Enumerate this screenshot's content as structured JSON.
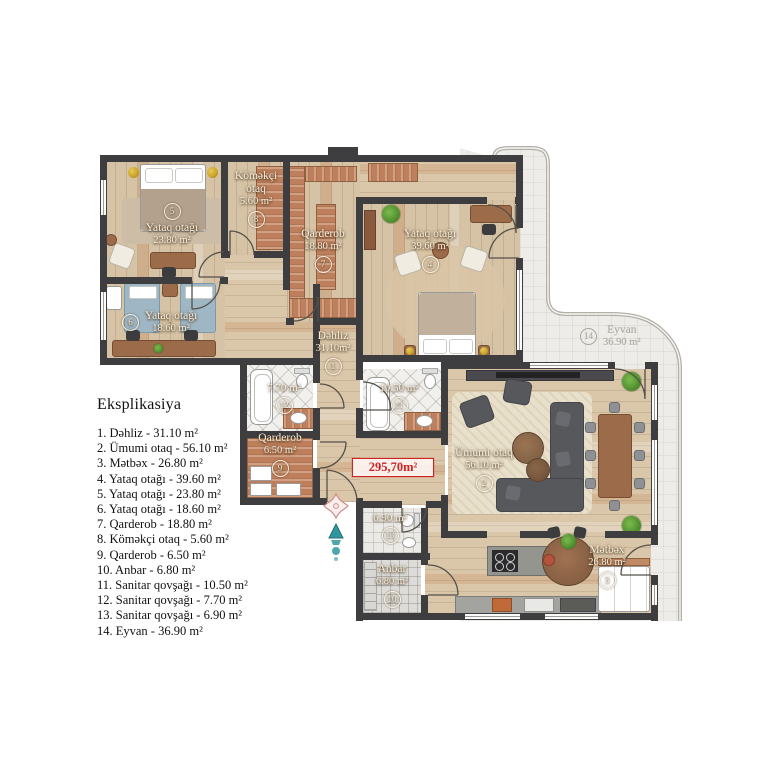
{
  "plan": {
    "total_area": "295,70m²",
    "rooms": {
      "r1": {
        "num": "1",
        "name": "Dəhliz",
        "area": "31.10m²"
      },
      "r2": {
        "num": "2",
        "name": "Ümumi otaq",
        "area": "56.10 m²"
      },
      "r3": {
        "num": "3",
        "name": "Mətbəx",
        "area": "26.80 m²"
      },
      "r4": {
        "num": "4",
        "name": "Yataq otağı",
        "area": "39.60 m²"
      },
      "r5": {
        "num": "5",
        "name": "Yataq otağı",
        "area": "23.80 m²"
      },
      "r6": {
        "num": "6",
        "name": "Yataq otağı",
        "area": "18.60 m²"
      },
      "r7": {
        "num": "7",
        "name": "Qarderob",
        "area": "18.80 m²"
      },
      "r8": {
        "num": "8",
        "name": "Köməkçi",
        "name2": "otaq",
        "area": "5.60 m²"
      },
      "r9": {
        "num": "9",
        "name": "Qarderob",
        "area": "6.50 m²"
      },
      "r10": {
        "num": "10",
        "name": "Anbar",
        "area": "6.80 m²"
      },
      "r11": {
        "num": "11",
        "area": "10.50 m²"
      },
      "r12": {
        "num": "12",
        "area": "7.70 m²"
      },
      "r13": {
        "num": "13",
        "area": "6.90 m²"
      },
      "r14": {
        "num": "14",
        "name": "Eyvan",
        "area": "36.90 m²"
      }
    }
  },
  "legend": {
    "title": "Eksplikasiya",
    "items": [
      "1. Dəhliz - 31.10 m²",
      "2. Ümumi otaq - 56.10 m²",
      "3. Mətbəx - 26.80 m²",
      "4. Yataq otağı - 39.60 m²",
      "5. Yataq otağı - 23.80 m²",
      "6. Yataq otağı - 18.60 m²",
      "7. Qarderob - 18.80 m²",
      "8. Köməkçi otaq - 5.60 m²",
      "9. Qarderob - 6.50 m²",
      "10. Anbar - 6.80 m²",
      "11. Sanitar qovşağı - 10.50 m²",
      "12. Sanitar qovşağı - 7.70 m²",
      "13. Sanitar qovşağı - 6.90 m²",
      "14. Eyvan - 36.90 m²"
    ]
  },
  "colors": {
    "wall": "#3e3e40",
    "wood": "#d6c3a5",
    "terracotta": "#bd7f5c",
    "accent_red": "#cf2222",
    "entry_teal": "#2f96a0",
    "balcony_tile": "#edece8"
  }
}
